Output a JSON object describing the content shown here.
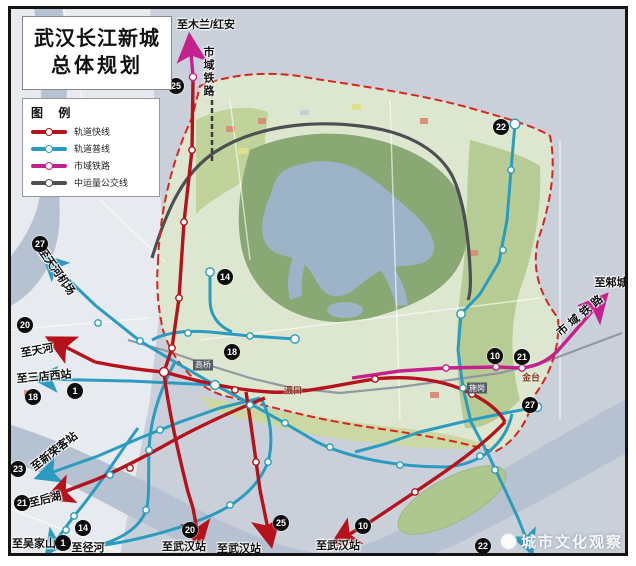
{
  "title": {
    "line1": "武汉长江新城",
    "line2": "总体规划"
  },
  "legend": {
    "heading": "图 例",
    "items": [
      {
        "label": "轨道快线",
        "color": "#b5121b"
      },
      {
        "label": "轨道普线",
        "color": "#2a9cc0"
      },
      {
        "label": "市域铁路",
        "color": "#c4218e"
      },
      {
        "label": "中运量公交线",
        "color": "#4d4f52"
      }
    ]
  },
  "watermark": {
    "text": "城市文化观察"
  },
  "map": {
    "badges": [
      {
        "n": "25",
        "x": 176,
        "y": 86
      },
      {
        "n": "22",
        "x": 501,
        "y": 127
      },
      {
        "n": "27",
        "x": 40,
        "y": 244
      },
      {
        "n": "14",
        "x": 225,
        "y": 277
      },
      {
        "n": "20",
        "x": 25,
        "y": 325
      },
      {
        "n": "18",
        "x": 232,
        "y": 352
      },
      {
        "n": "1",
        "x": 75,
        "y": 391
      },
      {
        "n": "18",
        "x": 33,
        "y": 397
      },
      {
        "n": "23",
        "x": 18,
        "y": 469
      },
      {
        "n": "21",
        "x": 22,
        "y": 503
      },
      {
        "n": "14",
        "x": 83,
        "y": 528
      },
      {
        "n": "1",
        "x": 63,
        "y": 543
      },
      {
        "n": "20",
        "x": 190,
        "y": 530
      },
      {
        "n": "25",
        "x": 281,
        "y": 523
      },
      {
        "n": "10",
        "x": 363,
        "y": 526
      },
      {
        "n": "22",
        "x": 483,
        "y": 546
      },
      {
        "n": "10",
        "x": 495,
        "y": 356
      },
      {
        "n": "21",
        "x": 522,
        "y": 357
      },
      {
        "n": "27",
        "x": 530,
        "y": 405
      }
    ],
    "labels": [
      {
        "t": "至木兰/红安",
        "x": 206,
        "y": 24,
        "r": 0,
        "c": "dest"
      },
      {
        "t": "市域铁路",
        "x": 208,
        "y": 72,
        "r": 0,
        "c": "dest vert"
      },
      {
        "t": "至邾城",
        "x": 611,
        "y": 282,
        "r": 0,
        "c": "dest"
      },
      {
        "t": "市域铁路",
        "x": 581,
        "y": 314,
        "r": -40,
        "c": "dest sp"
      },
      {
        "t": "至天河机场",
        "x": 57,
        "y": 271,
        "r": 55,
        "c": "dest"
      },
      {
        "t": "至天河",
        "x": 37,
        "y": 350,
        "r": -10,
        "c": "dest"
      },
      {
        "t": "至三店西站",
        "x": 44,
        "y": 376,
        "r": -5,
        "c": "dest"
      },
      {
        "t": "至新荣客站",
        "x": 54,
        "y": 451,
        "r": -38,
        "c": "dest"
      },
      {
        "t": "至后湖",
        "x": 45,
        "y": 499,
        "r": -14,
        "c": "dest"
      },
      {
        "t": "至吴家山",
        "x": 34,
        "y": 543,
        "r": 0,
        "c": "dest"
      },
      {
        "t": "至径河",
        "x": 88,
        "y": 547,
        "r": 0,
        "c": "dest"
      },
      {
        "t": "至武汉站",
        "x": 184,
        "y": 546,
        "r": 0,
        "c": "dest"
      },
      {
        "t": "至武汉站",
        "x": 239,
        "y": 548,
        "r": 0,
        "c": "dest"
      },
      {
        "t": "至武汉站",
        "x": 338,
        "y": 545,
        "r": 0,
        "c": "dest"
      },
      {
        "t": "高桥",
        "x": 203,
        "y": 365,
        "r": 0,
        "c": "tag"
      },
      {
        "t": "滠口",
        "x": 293,
        "y": 390,
        "r": 0,
        "c": "town"
      },
      {
        "t": "施岗",
        "x": 477,
        "y": 388,
        "r": 0,
        "c": "tag"
      },
      {
        "t": "金台",
        "x": 531,
        "y": 377,
        "r": 0,
        "c": "town"
      }
    ]
  }
}
